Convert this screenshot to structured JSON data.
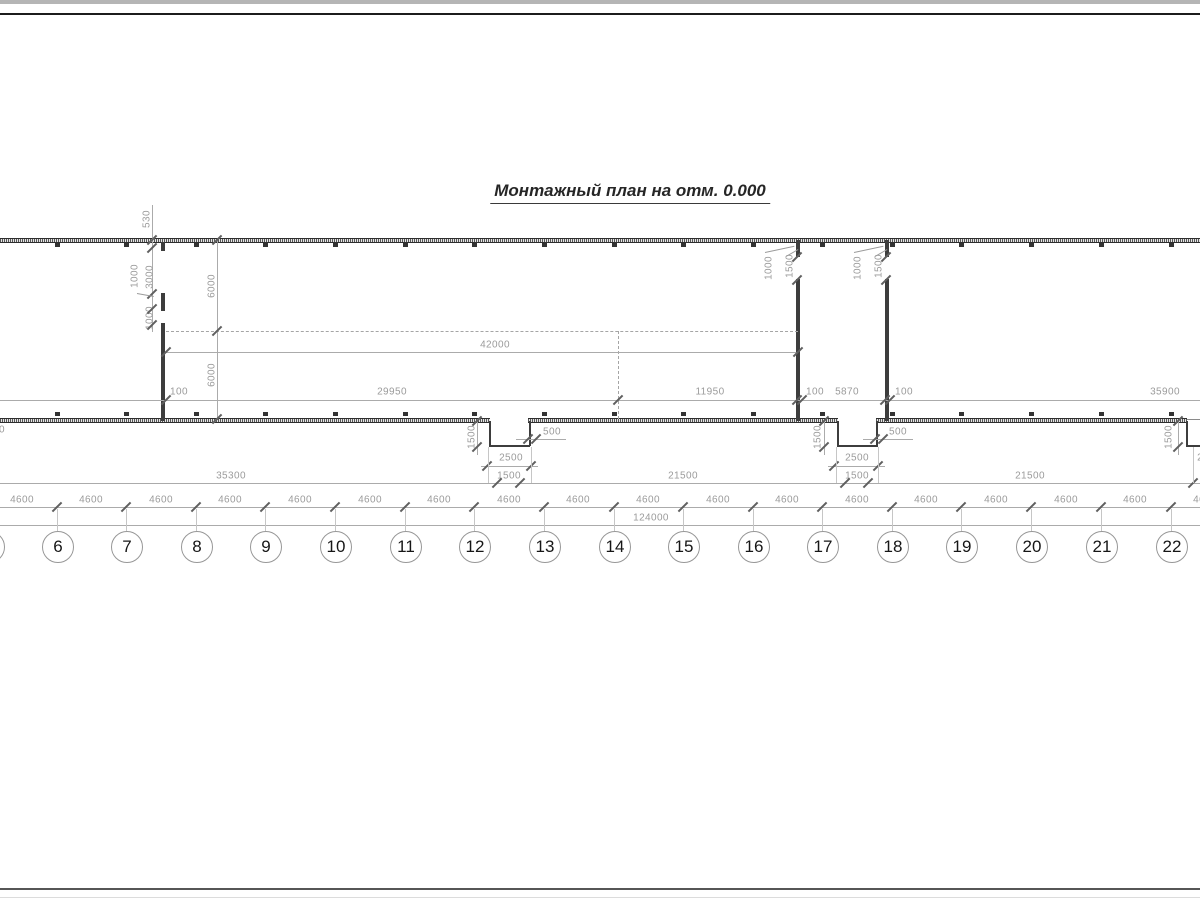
{
  "title": "Монтажный план на отм. 0.000",
  "colors": {
    "wall": "#3d3d3d",
    "dim_line": "#ababab",
    "dim_text": "#9b9b9b",
    "tick": "#5f5f5f"
  },
  "axes": {
    "circle_center_y": 546,
    "circles": [
      {
        "n": "5",
        "x": -12
      },
      {
        "n": "6",
        "x": 57
      },
      {
        "n": "7",
        "x": 126
      },
      {
        "n": "8",
        "x": 196
      },
      {
        "n": "9",
        "x": 265
      },
      {
        "n": "10",
        "x": 335
      },
      {
        "n": "11",
        "x": 405
      },
      {
        "n": "12",
        "x": 474
      },
      {
        "n": "13",
        "x": 544
      },
      {
        "n": "14",
        "x": 614
      },
      {
        "n": "15",
        "x": 683
      },
      {
        "n": "16",
        "x": 753
      },
      {
        "n": "17",
        "x": 822
      },
      {
        "n": "18",
        "x": 892
      },
      {
        "n": "19",
        "x": 961
      },
      {
        "n": "20",
        "x": 1031
      },
      {
        "n": "21",
        "x": 1101
      },
      {
        "n": "22",
        "x": 1171
      }
    ]
  },
  "labels": [
    {
      "t": "42000",
      "x": 495,
      "y": 345,
      "r": 0
    },
    {
      "t": "100",
      "x": 179,
      "y": 392,
      "r": 0
    },
    {
      "t": "29950",
      "x": 392,
      "y": 392,
      "r": 0
    },
    {
      "t": "11950",
      "x": 710,
      "y": 392,
      "r": 0
    },
    {
      "t": "100",
      "x": 815,
      "y": 392,
      "r": 0
    },
    {
      "t": "5870",
      "x": 847,
      "y": 392,
      "r": 0
    },
    {
      "t": "100",
      "x": 904,
      "y": 392,
      "r": 0
    },
    {
      "t": "35900",
      "x": 1165,
      "y": 392,
      "r": 0
    },
    {
      "t": "500",
      "x": 552,
      "y": 432,
      "r": 0
    },
    {
      "t": "500",
      "x": 898,
      "y": 432,
      "r": 0
    },
    {
      "t": "2500",
      "x": 511,
      "y": 458,
      "r": 0
    },
    {
      "t": "2500",
      "x": 857,
      "y": 458,
      "r": 0
    },
    {
      "t": "2500",
      "x": 1209,
      "y": 458,
      "r": 0
    },
    {
      "t": "35300",
      "x": 231,
      "y": 476,
      "r": 0
    },
    {
      "t": "1500",
      "x": 509,
      "y": 476,
      "r": 0
    },
    {
      "t": "21500",
      "x": 683,
      "y": 476,
      "r": 0
    },
    {
      "t": "1500",
      "x": 857,
      "y": 476,
      "r": 0
    },
    {
      "t": "21500",
      "x": 1030,
      "y": 476,
      "r": 0
    },
    {
      "t": "124000",
      "x": 651,
      "y": 518,
      "r": 0
    },
    {
      "t": "100",
      "x": -4,
      "y": 430,
      "r": 0
    },
    {
      "t": "4600",
      "x": 22,
      "y": 500,
      "r": 0
    },
    {
      "t": "4600",
      "x": 91,
      "y": 500,
      "r": 0
    },
    {
      "t": "4600",
      "x": 161,
      "y": 500,
      "r": 0
    },
    {
      "t": "4600",
      "x": 230,
      "y": 500,
      "r": 0
    },
    {
      "t": "4600",
      "x": 300,
      "y": 500,
      "r": 0
    },
    {
      "t": "4600",
      "x": 370,
      "y": 500,
      "r": 0
    },
    {
      "t": "4600",
      "x": 439,
      "y": 500,
      "r": 0
    },
    {
      "t": "4600",
      "x": 509,
      "y": 500,
      "r": 0
    },
    {
      "t": "4600",
      "x": 578,
      "y": 500,
      "r": 0
    },
    {
      "t": "4600",
      "x": 648,
      "y": 500,
      "r": 0
    },
    {
      "t": "4600",
      "x": 718,
      "y": 500,
      "r": 0
    },
    {
      "t": "4600",
      "x": 787,
      "y": 500,
      "r": 0
    },
    {
      "t": "4600",
      "x": 857,
      "y": 500,
      "r": 0
    },
    {
      "t": "4600",
      "x": 926,
      "y": 500,
      "r": 0
    },
    {
      "t": "4600",
      "x": 996,
      "y": 500,
      "r": 0
    },
    {
      "t": "4600",
      "x": 1066,
      "y": 500,
      "r": 0
    },
    {
      "t": "4600",
      "x": 1135,
      "y": 500,
      "r": 0
    },
    {
      "t": "4600",
      "x": 1205,
      "y": 500,
      "r": 0
    },
    {
      "t": "530",
      "x": 147,
      "y": 219,
      "r": 1
    },
    {
      "t": "1000",
      "x": 135,
      "y": 276,
      "r": 1
    },
    {
      "t": "3000",
      "x": 150,
      "y": 277,
      "r": 1
    },
    {
      "t": "1000",
      "x": 150,
      "y": 318,
      "r": 1
    },
    {
      "t": "6000",
      "x": 212,
      "y": 286,
      "r": 1
    },
    {
      "t": "6000",
      "x": 212,
      "y": 375,
      "r": 1
    },
    {
      "t": "1500",
      "x": 472,
      "y": 437,
      "r": 1
    },
    {
      "t": "1500",
      "x": 818,
      "y": 437,
      "r": 1
    },
    {
      "t": "1500",
      "x": 1169,
      "y": 437,
      "r": 1
    },
    {
      "t": "1000",
      "x": 769,
      "y": 268,
      "r": 1
    },
    {
      "t": "1500",
      "x": 790,
      "y": 266,
      "r": 1
    },
    {
      "t": "1000",
      "x": 858,
      "y": 268,
      "r": 1
    },
    {
      "t": "1500",
      "x": 879,
      "y": 266,
      "r": 1
    }
  ],
  "ticks": [
    [
      166,
      352
    ],
    [
      798,
      352
    ],
    [
      166,
      400
    ],
    [
      618,
      400
    ],
    [
      797,
      400
    ],
    [
      802,
      400
    ],
    [
      885,
      400
    ],
    [
      890,
      400
    ],
    [
      497,
      483
    ],
    [
      520,
      483
    ],
    [
      845,
      483
    ],
    [
      868,
      483
    ],
    [
      1193,
      483
    ],
    [
      528,
      439
    ],
    [
      536,
      439
    ],
    [
      875,
      439
    ],
    [
      883,
      439
    ],
    [
      487,
      466
    ],
    [
      531,
      466
    ],
    [
      834,
      466
    ],
    [
      878,
      466
    ],
    [
      152,
      240
    ],
    [
      152,
      248
    ],
    [
      152,
      294
    ],
    [
      152,
      309
    ],
    [
      152,
      325
    ],
    [
      217,
      240
    ],
    [
      217,
      331
    ],
    [
      217,
      419
    ],
    [
      477,
      421
    ],
    [
      477,
      447
    ],
    [
      824,
      421
    ],
    [
      824,
      447
    ],
    [
      1178,
      421
    ],
    [
      1178,
      447
    ],
    [
      797,
      257
    ],
    [
      797,
      280
    ],
    [
      886,
      257
    ],
    [
      886,
      280
    ]
  ],
  "leaders": [
    [
      137,
      293,
      17,
      10
    ],
    [
      765,
      252,
      30,
      -12
    ],
    [
      786,
      256,
      14,
      -30
    ],
    [
      854,
      252,
      30,
      -12
    ],
    [
      875,
      256,
      14,
      -30
    ]
  ],
  "ext_lines": [
    [
      488,
      447,
      36
    ],
    [
      531,
      447,
      36
    ],
    [
      836,
      447,
      36
    ],
    [
      878,
      447,
      36
    ],
    [
      1193,
      447,
      36
    ]
  ]
}
